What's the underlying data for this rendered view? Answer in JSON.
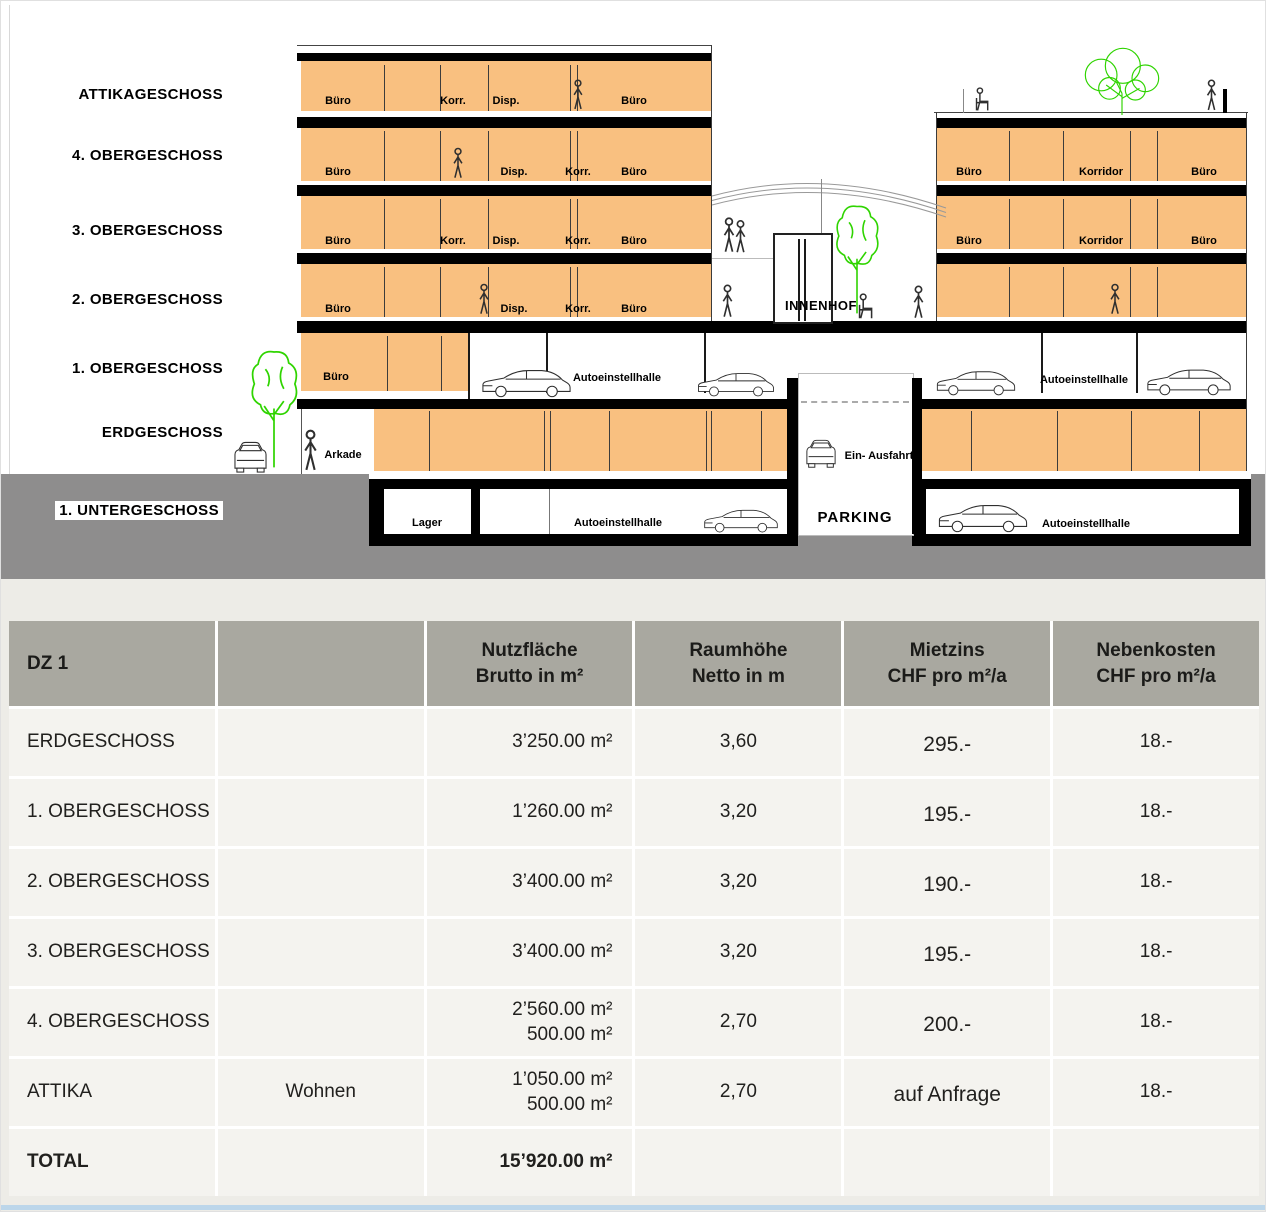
{
  "section": {
    "floor_labels": [
      "ATTIKAGESCHOSS",
      "4. OBERGESCHOSS",
      "3. OBERGESCHOSS",
      "2. OBERGESCHOSS",
      "1. OBERGESCHOSS",
      "ERDGESCHOSS",
      "1. UNTERGESCHOSS"
    ],
    "room_labels": {
      "buero": "Büro",
      "korr": "Korr.",
      "disp": "Disp.",
      "korridor": "Korridor",
      "autoeinstellhalle": "Autoeinstellhalle",
      "lager": "Lager",
      "arkade": "Arkade",
      "innenhof": "INNENHOF",
      "ein_ausfahrt": "Ein- Ausfahrt",
      "parking": "PARKING"
    },
    "colors": {
      "floor_fill": "#f9c080",
      "ground": "#8e8d8d",
      "tree_green": "#2fd400",
      "slab": "#000000",
      "table_header_bg": "#a9a8a0",
      "table_row_bg": "#f4f3ef",
      "page_lower_bg": "#edece7",
      "bottom_bar": "#bcd6ea"
    }
  },
  "table": {
    "header": [
      "DZ 1",
      "",
      "Nutzfläche\nBrutto in m²",
      "Raumhöhe\nNetto in m",
      "Mietzins\nCHF pro m²/a",
      "Nebenkosten\nCHF pro m²/a"
    ],
    "rows": [
      {
        "floor": "ERDGESCHOSS",
        "usage": "",
        "area": "3’250.00 m²",
        "height": "3,60",
        "rent": "295.-",
        "extra": "18.-"
      },
      {
        "floor": "1. OBERGESCHOSS",
        "usage": "",
        "area": "1’260.00 m²",
        "height": "3,20",
        "rent": "195.-",
        "extra": "18.-"
      },
      {
        "floor": "2. OBERGESCHOSS",
        "usage": "",
        "area": "3’400.00 m²",
        "height": "3,20",
        "rent": "190.-",
        "extra": "18.-"
      },
      {
        "floor": "3. OBERGESCHOSS",
        "usage": "",
        "area": "3’400.00 m²",
        "height": "3,20",
        "rent": "195.-",
        "extra": "18.-"
      },
      {
        "floor": "4. OBERGESCHOSS",
        "usage": "",
        "area": "2’560.00 m²\n500.00 m²",
        "height": "2,70",
        "rent": "200.-",
        "extra": "18.-"
      },
      {
        "floor": "ATTIKA",
        "usage": "Wohnen",
        "area": "1’050.00 m²\n500.00 m²",
        "height": "2,70",
        "rent": "auf Anfrage",
        "extra": "18.-"
      },
      {
        "floor": "TOTAL",
        "usage": "",
        "area": "15’920.00 m²",
        "height": "",
        "rent": "",
        "extra": ""
      }
    ]
  }
}
